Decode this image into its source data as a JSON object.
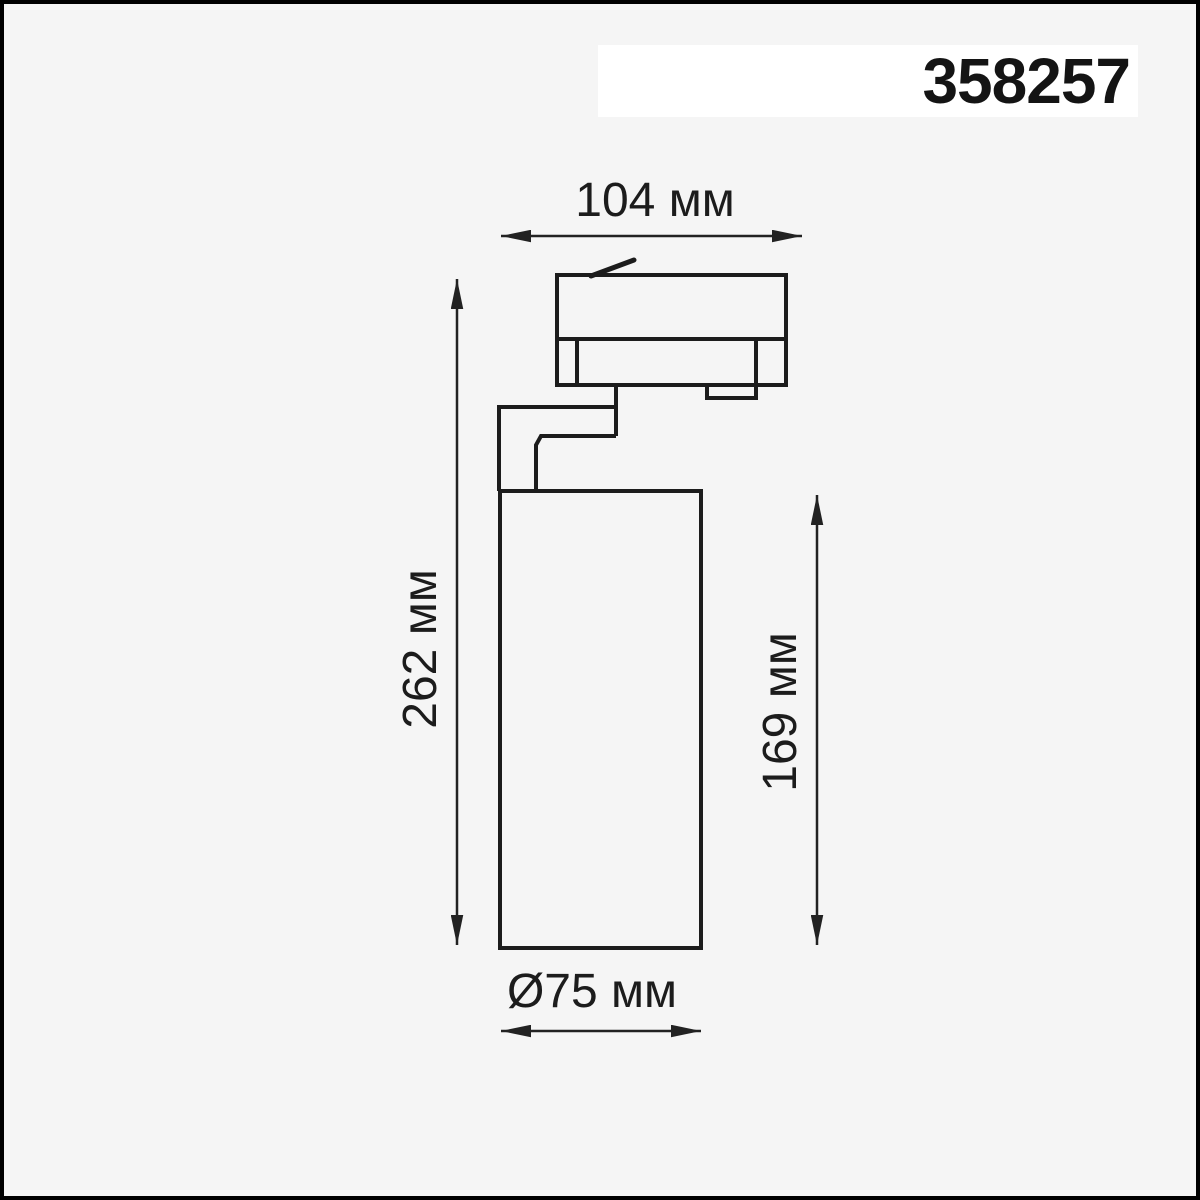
{
  "header": {
    "article": "358257"
  },
  "dimensions": {
    "width_label": "104 мм",
    "total_height_label": "262 мм",
    "body_height_label": "169 мм",
    "diameter_label": "Ø75 мм"
  },
  "diagram": {
    "type": "technical-dimension-drawing",
    "view": "side view of track-mounted cylindrical spotlight",
    "parts": [
      "track-adapter",
      "adapter-latch",
      "adapter-lever",
      "mounting-arm",
      "cylinder-body"
    ]
  },
  "colors": {
    "background": "#f5f5f5",
    "frame_border": "#000000",
    "band_background": "#ffffff",
    "line": "#1c1c1c",
    "text": "#1c1c1c"
  }
}
